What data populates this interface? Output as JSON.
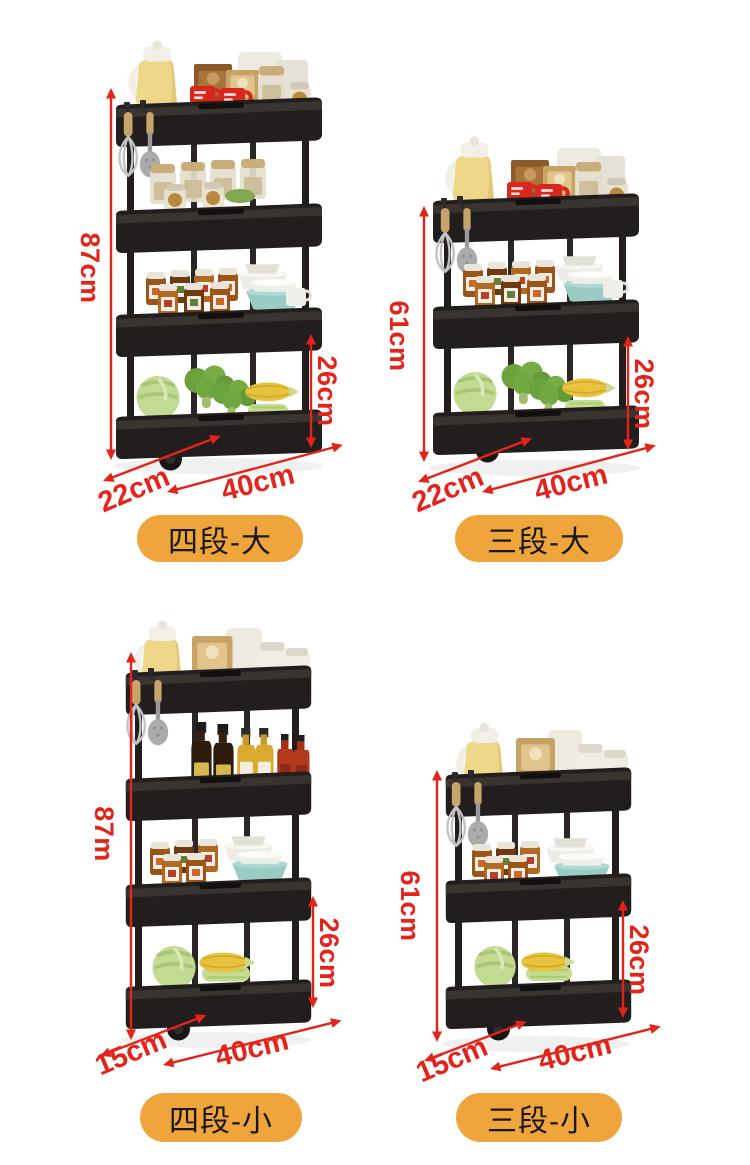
{
  "page": {
    "background": "#ffffff"
  },
  "palette": {
    "dimension_red": "#E2241A",
    "badge_orange": "#F0A43C",
    "badge_text": "#181818",
    "cart_black": "#221E1D"
  },
  "products": [
    {
      "variant_name": "四段-大",
      "tiers": 4,
      "height": "87cm",
      "tier_gap": "26cm",
      "depth": "22cm",
      "width": "40cm"
    },
    {
      "variant_name": "三段-大",
      "tiers": 3,
      "height": "61cm",
      "tier_gap": "26cm",
      "depth": "22cm",
      "width": "40cm"
    },
    {
      "variant_name": "四段-小",
      "tiers": 4,
      "height": "87m",
      "tier_gap": "26cm",
      "depth": "15cm",
      "width": "40cm"
    },
    {
      "variant_name": "三段-小",
      "tiers": 3,
      "height": "61cm",
      "tier_gap": "26cm",
      "depth": "15cm",
      "width": "40cm"
    }
  ]
}
